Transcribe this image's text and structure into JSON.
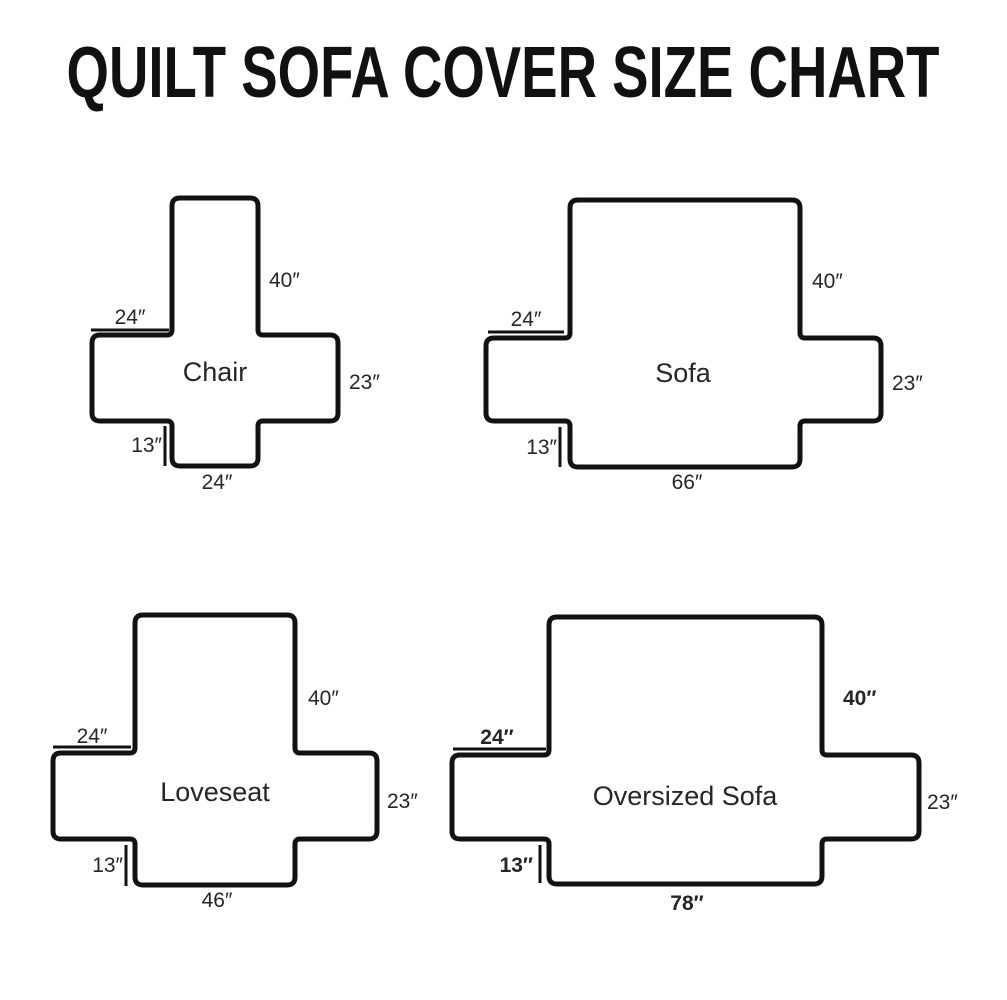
{
  "title": "QUILT SOFA COVER SIZE CHART",
  "colors": {
    "line": "#121212",
    "text": "#262626",
    "background": "#ffffff"
  },
  "items": [
    {
      "name": "Chair",
      "back_height": "40″",
      "back_width": "24″",
      "arm_side": "23″",
      "front_drop": "13″",
      "front_width": "24″"
    },
    {
      "name": "Sofa",
      "back_height": "40″",
      "back_width": "24″",
      "arm_side": "23″",
      "front_drop": "13″",
      "front_width": "66″"
    },
    {
      "name": "Loveseat",
      "back_height": "40″",
      "back_width": "24″",
      "arm_side": "23″",
      "front_drop": "13″",
      "front_width": "46″"
    },
    {
      "name": "Oversized Sofa",
      "back_height": "40″",
      "back_width": "24″",
      "arm_side": "23″",
      "front_drop": "13″",
      "front_width": "78″"
    }
  ]
}
